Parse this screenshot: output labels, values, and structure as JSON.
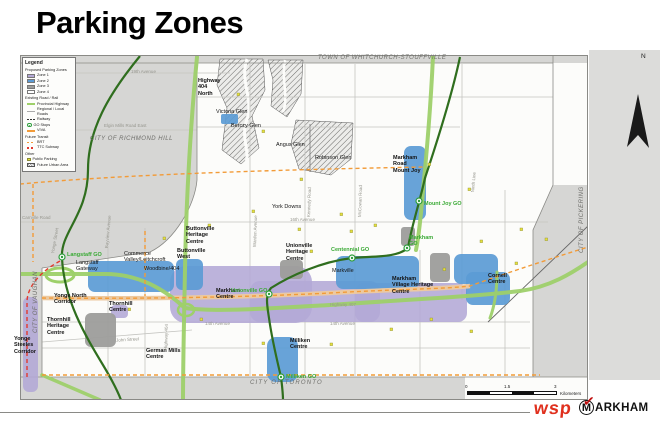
{
  "title": "Parking Zones",
  "legend": {
    "title": "Legend",
    "zones_heading": "Proposed Parking Zones",
    "zones": [
      {
        "label": "Zone 1",
        "color": "#b3a8d6"
      },
      {
        "label": "Zone 2",
        "color": "#5b9bd5"
      },
      {
        "label": "Zone 3",
        "color": "#9d9d9b"
      },
      {
        "label": "Zone 4",
        "color": "#ffffff"
      }
    ],
    "road_heading": "Existing Road / Rail",
    "road_items": [
      "Provincial Highway",
      "Regional / Local Roads",
      "Railway",
      "GO Stops",
      "VIVA"
    ],
    "future_heading": "Future Transit",
    "future_items": [
      "BRT",
      "TTC Subway"
    ],
    "other_heading": "Other",
    "other_items": [
      "Public Parking",
      "Future Urban Area"
    ]
  },
  "map": {
    "municipalities": {
      "north": "TOWN OF WHITCHURCH-STOUFFVILLE",
      "northwest": "CITY OF RICHMOND HILL",
      "west": "CITY OF VAUGHAN",
      "east": "CITY OF PICKERING",
      "south": "CITY OF TORONTO"
    },
    "area_labels": [
      "Highway\n404\nNorth",
      "Victoria Glen",
      "Berczy Glen",
      "Angus Glen",
      "Robinson Glen",
      "Markham\nRoad\nMount Joy",
      "York Downs",
      "Buttonville\nHeritage\nCentre",
      "Buttonville\nWest",
      "Commerce\nValley/Leitchcroft",
      "Woodbine/404",
      "Langstaff\nGateway",
      "Yonge North\nCorridor",
      "Thornhill\nCentre",
      "Thornhill\nHeritage\nCentre",
      "Yonge\nSteeles\nCorridor",
      "German Mills\nCentre",
      "Markham\nCentre",
      "Unionville\nHeritage\nCentre",
      "Markville",
      "Markham\nVillage Heritage\nCentre",
      "Cornell\nCentre",
      "Milliken\nCentre"
    ],
    "go_stations": [
      "Langstaff GO",
      "Unionville GO",
      "Centennial GO",
      "Markham\nGO",
      "Mount Joy GO",
      "Milliken GO"
    ],
    "road_labels": [
      "19th Avenue",
      "Elgin Mills Road East",
      "Carrville Road",
      "16th Avenue",
      "14th Avenue",
      "14th Avenue",
      "Highway 407",
      "John Street",
      "Yonge Street",
      "Bayview Avenue",
      "Kennedy Road",
      "McCowan Road",
      "Warden Avenue",
      "Ninth Line",
      "Highway 404"
    ],
    "north_label": "N",
    "scale": {
      "ticks": [
        "0",
        "1.5",
        "3"
      ],
      "unit": "Kilometers"
    }
  },
  "footer": {
    "wsp": "wsp",
    "markham_m": "M",
    "markham_check": "✓",
    "markham_rest": "ARKHAM",
    "accent_red": "#e0301e"
  }
}
